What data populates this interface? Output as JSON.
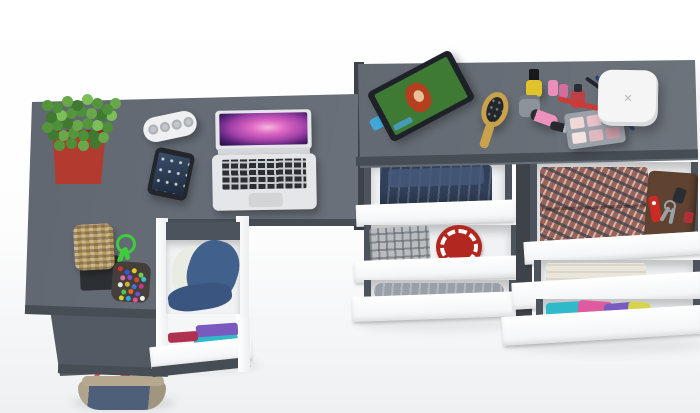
{
  "palette": {
    "background_top": "#ffffff",
    "background_bottom": "#eef0f2",
    "desk": "#5a616b",
    "desk_return": "#545a63",
    "desk_edge": "#474d55",
    "dresser": "#5d646d",
    "dresser_side": "#3e434a",
    "drawer_front": "#ffffff",
    "drawer_interior": "#f1f2f3",
    "rail": "#4d535c"
  },
  "desk_items": {
    "plant": {
      "pot": "#b23a2e",
      "pot_rim": "#8e2c24",
      "foliage": "#55963c"
    },
    "speaker": {
      "body": "#eef0f1",
      "grille": "#c3c7cb"
    },
    "phone": {
      "body": "#23262c"
    },
    "laptop": {
      "body": "#e4e6e9",
      "hinge": "#d5d7da",
      "trackpad": "#d2d4d6"
    }
  },
  "dresser_items": {
    "tablet": {
      "frame": "#1e2228",
      "screen_bg": "#3f7a35",
      "hair": "#b5401f",
      "face": "#e8c09a",
      "stand": "#3fa8d8"
    },
    "hairbrush": {
      "handle": "#c9a24b",
      "bristles": "#23262a"
    },
    "makeup": {
      "nail_polish_yellow": "#e0c22a",
      "jar": "#8d939b",
      "nail_polish_pink": "#e890b8",
      "nail_polish_rose": "#d36d9e",
      "nail_polish_red": "#c13f47",
      "tube": "#ec92bc",
      "lipstick": "#26292e",
      "palette_case": "#9ba1a8"
    },
    "pencils": {
      "red": "#cc3b36",
      "blue": "#2e4470",
      "black": "#23262b"
    },
    "device": {
      "body": "#f4f5f4",
      "logo": "✕"
    }
  },
  "pedestal": {
    "jacket": "#41608c",
    "jacket_fold": "#3a5680",
    "lining": "#e9ece3",
    "clothes": [
      "#7a5abf",
      "#2fb9c9",
      "#b03050"
    ]
  },
  "chest_left": {
    "jeans": "#31405a",
    "jeans_fold": "#47597a",
    "plaid_shirt": "#b9bdc1",
    "round_mat": "#b2271f",
    "garment": "#9aa0a8"
  },
  "chest_right": {
    "plaid_shirt": "#9a6258",
    "wallet": "#5f4230",
    "knife": "#cc2a22",
    "keys": "#9aa0a6",
    "fob": "#2a2d33",
    "tag": "#b03038",
    "towel": "#eae6dc",
    "shirts": [
      "#2fb9c9",
      "#df5a9e",
      "#7a5abf",
      "#d6d44e"
    ]
  },
  "floor_items": {
    "basket": "#b99a5f",
    "tray": "#2c2f33",
    "cord": "#3ecb3e",
    "pouch": "#453f3c",
    "bag_body": "#4e5f7a",
    "bag_trim": "#b5a88e",
    "bag_strap": "#e34f63"
  }
}
